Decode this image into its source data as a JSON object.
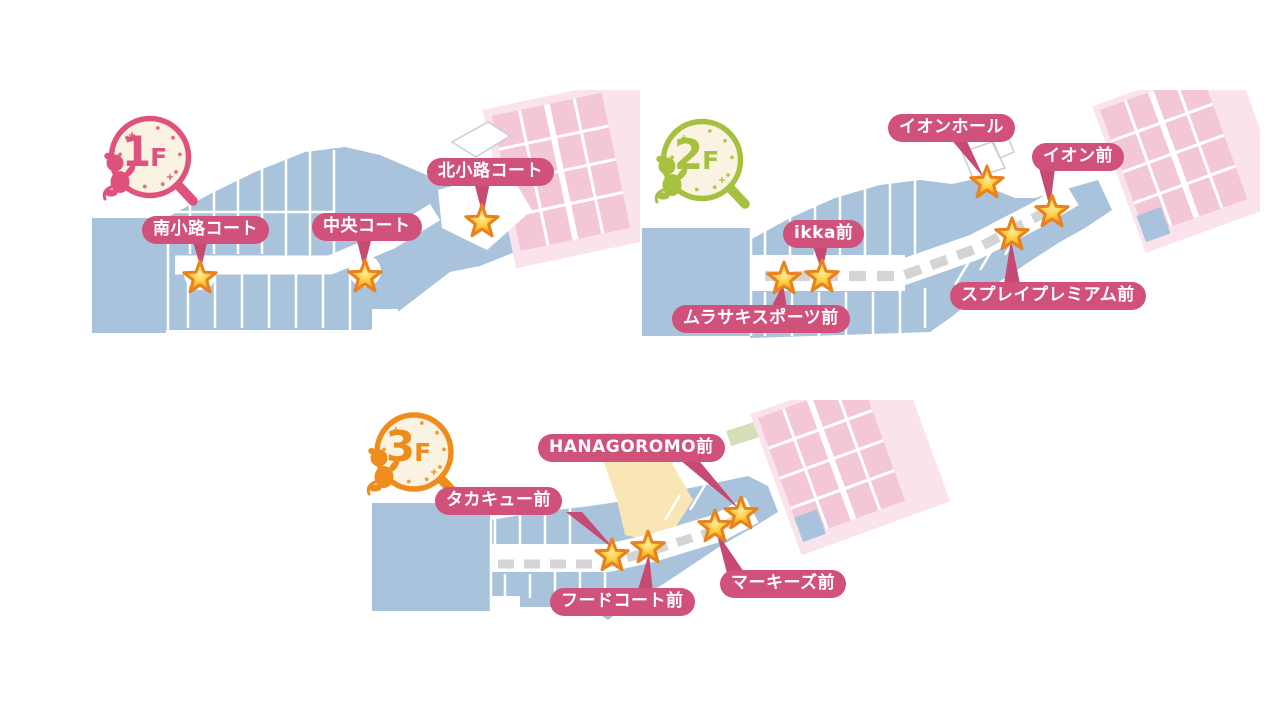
{
  "floors": [
    {
      "badge": {
        "number": "1",
        "suffix": "F",
        "color": "#e0527e"
      },
      "markers": [
        {
          "label": "南小路コート"
        },
        {
          "label": "中央コート"
        },
        {
          "label": "北小路コート"
        }
      ],
      "star_count": 3
    },
    {
      "badge": {
        "number": "2",
        "suffix": "F",
        "color": "#a5c13f"
      },
      "markers": [
        {
          "label": "イオンホール"
        },
        {
          "label": "イオン前"
        },
        {
          "label": "スプレイプレミアム前"
        },
        {
          "label": "ikka前"
        },
        {
          "label": "ムラサキスポーツ前"
        }
      ],
      "star_count": 5
    },
    {
      "badge": {
        "number": "3",
        "suffix": "F",
        "color": "#ef8c1e"
      },
      "markers": [
        {
          "label": "HANAGOROMO前"
        },
        {
          "label": "タカキュー前"
        },
        {
          "label": "フードコート前"
        },
        {
          "label": "マーキーズ前"
        }
      ],
      "star_count": 4
    }
  ],
  "colors": {
    "building_fill": "#a9c3dd",
    "dept_store_fill": "#f3c7d8",
    "dept_store_outer": "#fbe3ed",
    "food_court_fill": "#fae5b4",
    "hall_outline": "#c8cdd5",
    "label_bg": "#d0527a",
    "label_pointer": "#c64a71",
    "star_fill": "#f9b32a",
    "star_border": "#e7821e",
    "route_dash": "#d4d4d4",
    "badge_face": "#faf3e2",
    "badge_1f": "#e0527e",
    "badge_2f": "#a5c13f",
    "badge_3f": "#ef8c1e"
  }
}
